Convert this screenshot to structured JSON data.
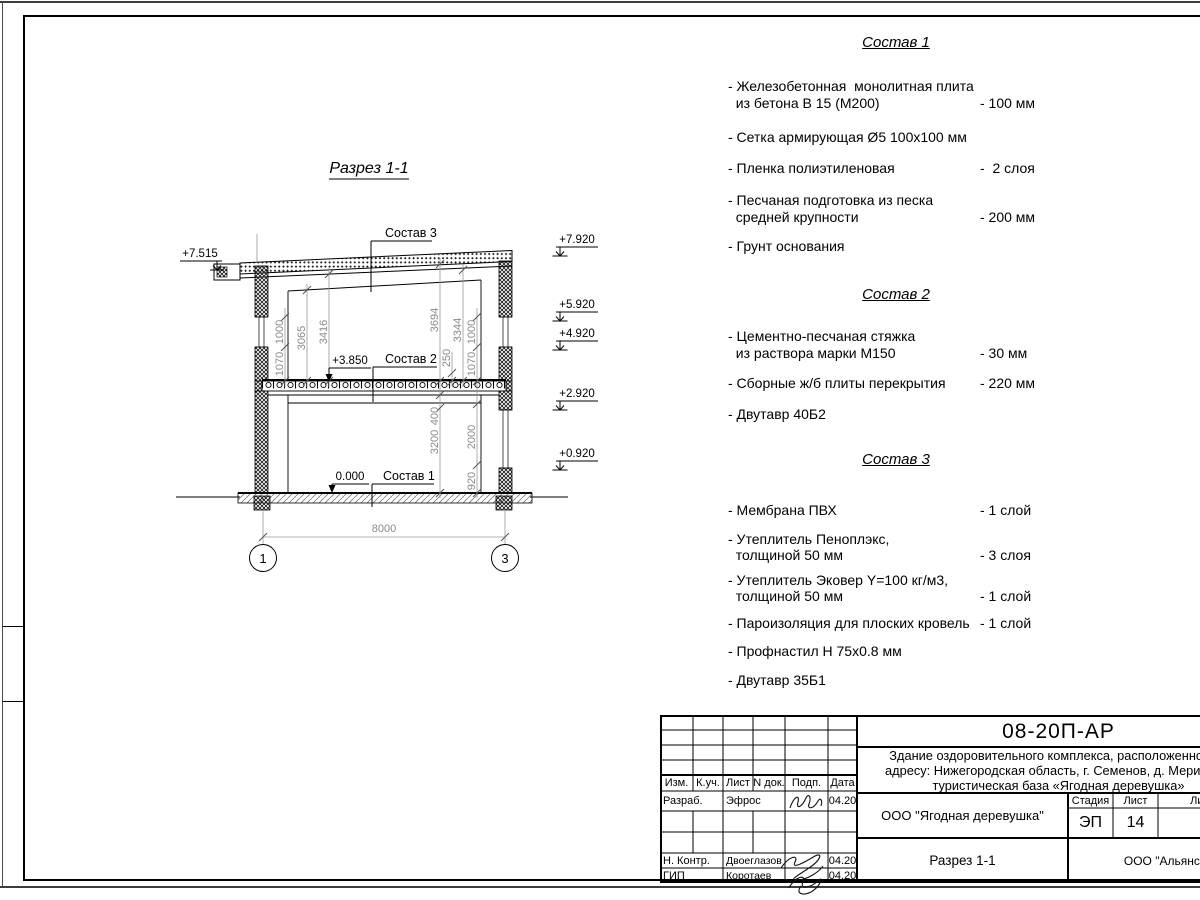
{
  "drawing": {
    "title": "Разрез 1-1",
    "labels": {
      "layer3": "Состав 3",
      "layer2": "Состав 2",
      "layer1": "Состав 1"
    },
    "elevations": {
      "left": "+7.515",
      "right": [
        "+7.920",
        "+5.920",
        "+4.920",
        "+2.920",
        "+0.920"
      ],
      "slab": "+3.850",
      "zero": "0.000"
    },
    "dimensions": {
      "win_h_left": "1000",
      "sill_left": "1070",
      "h_3065": "3065",
      "h_3416": "3416",
      "h_3694": "3694",
      "h_3344": "3344",
      "slab_250": "250",
      "win_h_right": "1000",
      "sill_right": "1070",
      "beam_400": "400",
      "h_3200": "3200",
      "win_2000": "2000",
      "sill_920": "920",
      "span": "8000"
    },
    "axes": {
      "a1": "1",
      "a3": "3"
    }
  },
  "lists": [
    {
      "title": "Состав 1",
      "items": [
        {
          "name": "- Железобетонная  монолитная плита\n  из бетона В 15 (М200)",
          "value": "- 100 мм"
        },
        {
          "name": "- Сетка армирующая Ø5 100х100 мм",
          "value": ""
        },
        {
          "name": "- Пленка полиэтиленовая",
          "value": "-  2 слоя"
        },
        {
          "name": "- Песчаная подготовка из песка\n  средней крупности",
          "value": "- 200 мм"
        },
        {
          "name": "- Грунт основания",
          "value": ""
        }
      ]
    },
    {
      "title": "Состав 2",
      "items": [
        {
          "name": "- Цементно-песчаная стяжка\n  из раствора марки М150",
          "value": "- 30 мм"
        },
        {
          "name": "- Сборные ж/б плиты перекрытия",
          "value": "- 220 мм"
        },
        {
          "name": "- Двутавр 40Б2",
          "value": ""
        }
      ]
    },
    {
      "title": "Состав 3",
      "items": [
        {
          "name": "- Мембрана ПВХ",
          "value": "- 1 слой"
        },
        {
          "name": "- Утеплитель Пеноплэкс,\n  толщиной 50 мм",
          "value": "- 3 слоя"
        },
        {
          "name": "- Утеплитель Эковер Y=100 кг/м3,\n  толщиной 50 мм",
          "value": "- 1 слой"
        },
        {
          "name": "- Пароизоляция для плоских кровель",
          "value": "- 1 слой"
        },
        {
          "name": "- Профнастил Н 75х0.8 мм",
          "value": ""
        },
        {
          "name": "- Двутавр 35Б1",
          "value": ""
        }
      ]
    }
  ],
  "titleblock": {
    "doc_number": "08-20П-АР",
    "description_line1": "Здание оздоровительного комплекса, расположенное по",
    "description_line2": "адресу: Нижегородская область, г. Семенов, д. Мериново,",
    "description_line3": "туристическая база «Ягодная деревушка»",
    "columns": {
      "izm": "Изм.",
      "kuch": "К.уч.",
      "list": "Лист",
      "ndok": "N док.",
      "podp": "Подп.",
      "data": "Дата"
    },
    "rows": {
      "razrab": {
        "role": "Разраб.",
        "name": "Эфрос",
        "date": "04.20"
      },
      "nkontr": {
        "role": "Н. Контр.",
        "name": "Двоеглазов",
        "date": "04.20"
      },
      "gip": {
        "role": "ГИП",
        "name": "Коротаев",
        "date": "04.20"
      }
    },
    "org": "ООО \"Ягодная деревушка\"",
    "stage_label": "Стадия",
    "sheet_label": "Лист",
    "sheets_label": "Листов",
    "stage": "ЭП",
    "sheet_num": "14",
    "view_name": "Разрез 1-1",
    "contractor": "ООО \"Альянс\""
  }
}
